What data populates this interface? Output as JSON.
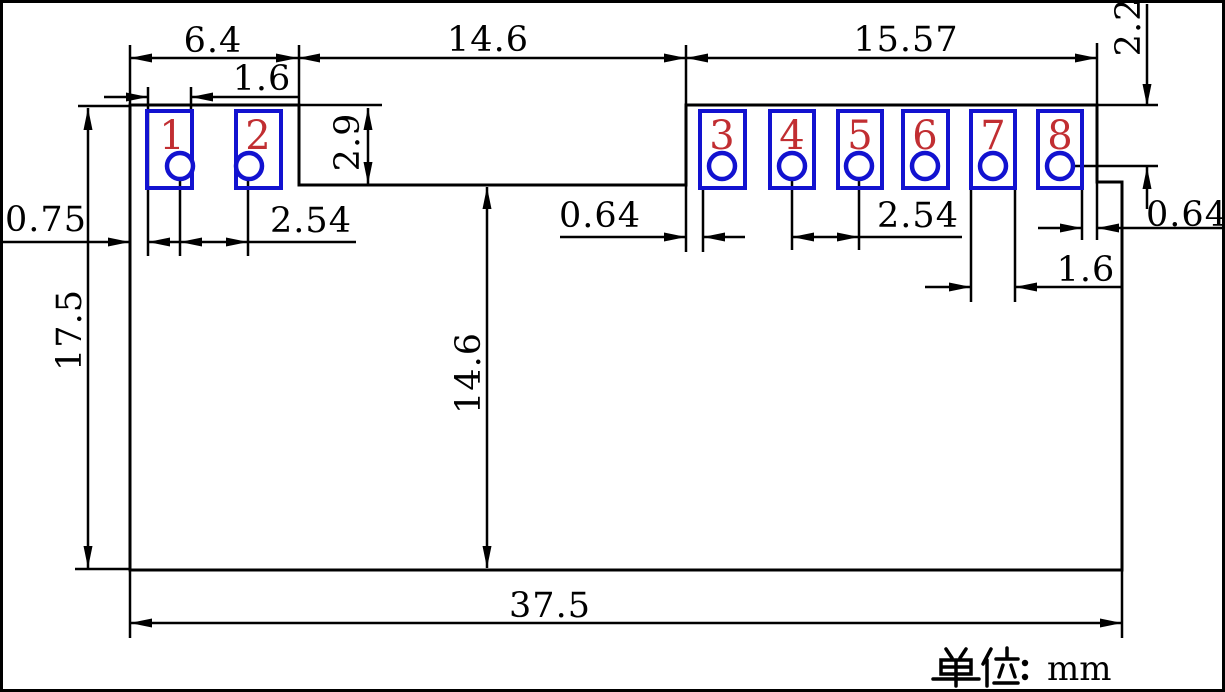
{
  "drawing": {
    "title": "8-pin module footprint dimension drawing",
    "units_label": "单位：mm",
    "units_suffix": "mm",
    "pads": [
      {
        "number": "1"
      },
      {
        "number": "2"
      },
      {
        "number": "3"
      },
      {
        "number": "4"
      },
      {
        "number": "5"
      },
      {
        "number": "6"
      },
      {
        "number": "7"
      },
      {
        "number": "8"
      }
    ],
    "dimensions": {
      "left_section_width": "6.4",
      "notch_width": "14.6",
      "right_section_width": "15.57",
      "pad_width_left": "1.6",
      "notch_depth": "2.9",
      "edge_to_pad1": "0.75",
      "pad_pitch_left": "2.54",
      "board_height": "17.5",
      "notch_to_bottom_height": "14.6",
      "notch_to_pad3_gap": "0.64",
      "pad_pitch_right": "2.54",
      "pad_width_right": "1.6",
      "pad8_to_edge_gap": "0.64",
      "top_edge_to_hole_center": "2.2",
      "board_width": "37.5"
    },
    "colors": {
      "pad_outline": "#1212d0",
      "pad_number": "#c12e32",
      "dimension_lines": "#000000",
      "background": "#ffffff"
    }
  }
}
